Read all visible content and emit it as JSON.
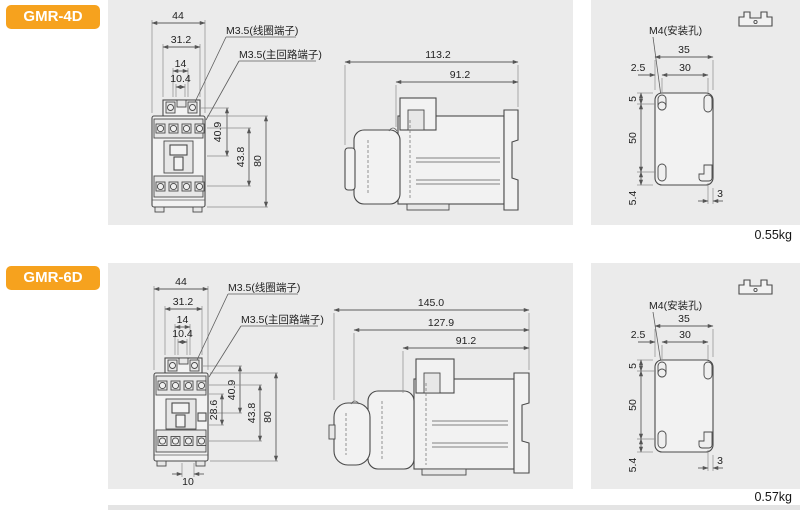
{
  "page": {
    "background": "#ffffff",
    "panel_bg": "#ebebeb",
    "accent": "#f6a21e",
    "line_color": "#4a4a4a"
  },
  "sections": [
    {
      "badge": "GMR-4D",
      "weight": "0.55kg",
      "front": {
        "d44": "44",
        "d31_2": "31.2",
        "d14": "14",
        "d10_4": "10.4",
        "d40_9": "40.9",
        "d43_8": "43.8",
        "d80": "80",
        "coil_label": "M3.5(线圈端子)",
        "main_label": "M3.5(主回路端子)"
      },
      "side": {
        "d_total": "113.2",
        "d_body": "91.2"
      },
      "mount": {
        "hole_label": "M4(安装孔)",
        "d35": "35",
        "d30": "30",
        "d2_5": "2.5",
        "d5": "5",
        "d50": "50",
        "d5_4": "5.4",
        "d3": "3"
      }
    },
    {
      "badge": "GMR-6D",
      "weight": "0.57kg",
      "front": {
        "d44": "44",
        "d31_2": "31.2",
        "d14": "14",
        "d10_4": "10.4",
        "d40_9": "40.9",
        "d28_6": "28.6",
        "d43_8": "43.8",
        "d80": "80",
        "d10": "10",
        "coil_label": "M3.5(线圈端子)",
        "main_label": "M3.5(主回路端子)"
      },
      "side": {
        "d_total": "145.0",
        "d_mid": "127.9",
        "d_body": "91.2"
      },
      "mount": {
        "hole_label": "M4(安装孔)",
        "d35": "35",
        "d30": "30",
        "d2_5": "2.5",
        "d5": "5",
        "d50": "50",
        "d5_4": "5.4",
        "d3": "3"
      }
    }
  ]
}
